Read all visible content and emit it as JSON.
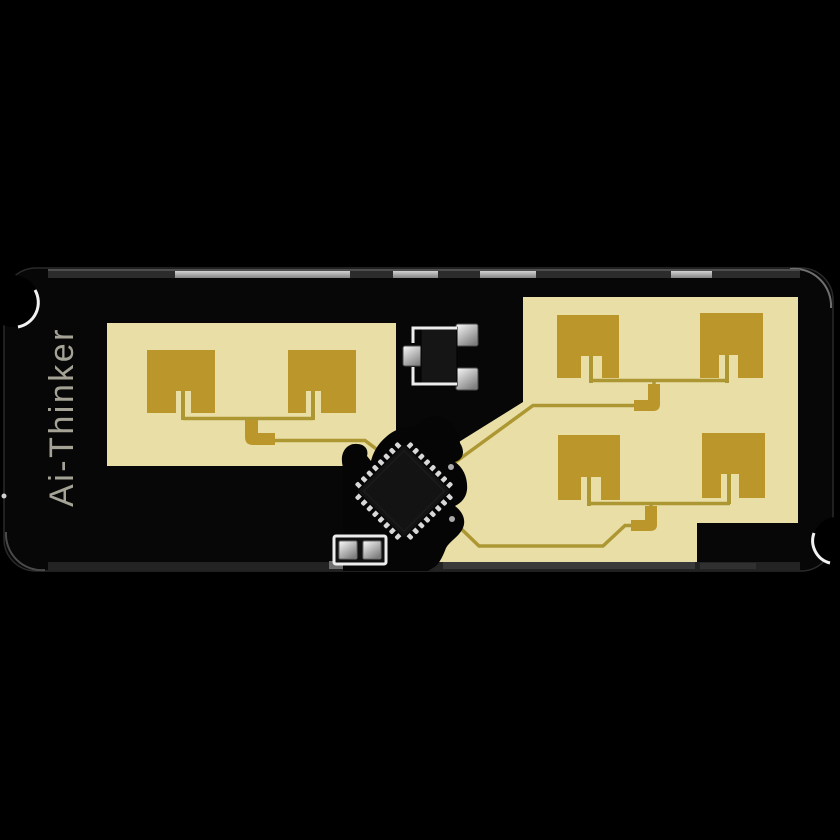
{
  "board": {
    "brand_label": "Ai-Thinker"
  },
  "colors": {
    "background": "#000000",
    "pcb_body": "#070707",
    "pcb_edge": "#2a2a2a",
    "substrate": "#e9dfa6",
    "patch_gold": "#bb962b",
    "trace_gold": "#ad9733",
    "ic_body": "#131313",
    "pin_metal": "#d8d8d8",
    "silkscreen": "#ededed",
    "edge_pad": "#9a9a9a",
    "edge_strip": "#2c2c2c",
    "brand_text": "#a5a396",
    "notch_highlight": "#f2f2f2"
  }
}
